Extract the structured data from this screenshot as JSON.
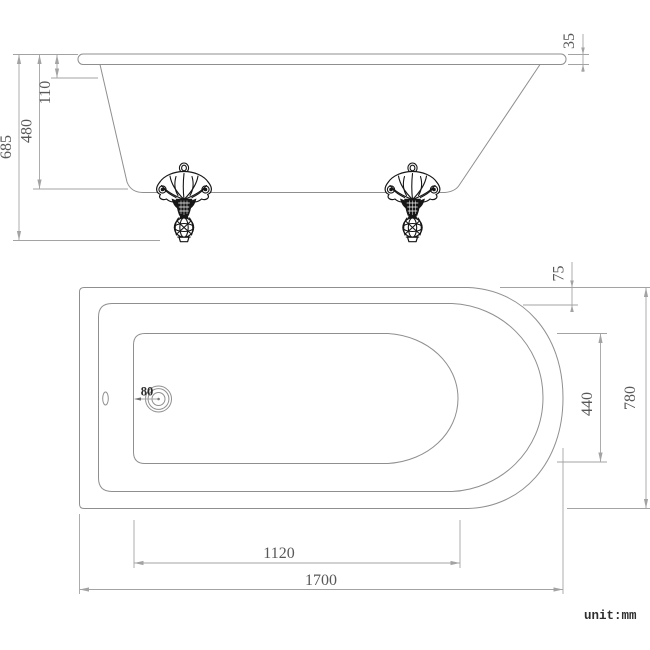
{
  "drawing": {
    "side_view": {
      "overall_height": "685",
      "tub_depth": "480",
      "rim_to_shoulder": "110",
      "rim_thickness": "35"
    },
    "plan_view": {
      "rim_width": "75",
      "interior_width": "440",
      "overall_width": "780",
      "drain_diameter": "80",
      "interior_length": "1120",
      "overall_length": "1700"
    },
    "unit_note": "unit:mm",
    "colors": {
      "outline": "#8f8f8f",
      "dimension_line": "#a3a3a3",
      "dimension_text": "#585858",
      "claw_foot": "#161616",
      "background": "#ffffff"
    }
  }
}
